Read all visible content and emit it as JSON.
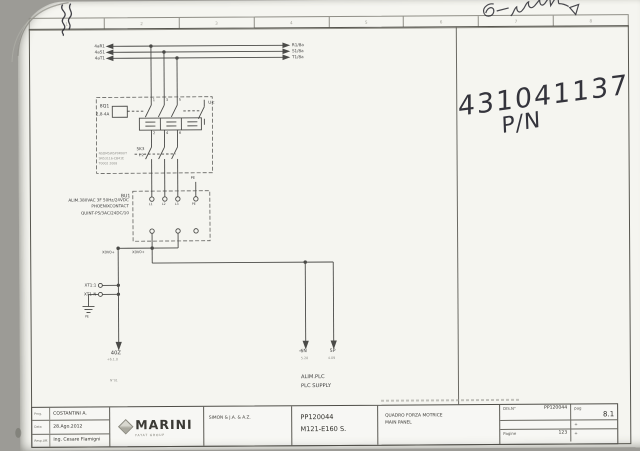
{
  "scan": {
    "part_number": "431041137",
    "part_number_label": "P/N"
  },
  "ruler": {
    "cols": [
      "1",
      "2",
      "3",
      "4",
      "5",
      "6",
      "7",
      "8"
    ]
  },
  "schematic": {
    "bus_left": [
      "4aR1",
      "4aS1",
      "4aT1"
    ],
    "bus_right": [
      "R1/8a",
      "S1/8a",
      "T1/8a"
    ],
    "breaker": {
      "tag": "8Q1",
      "range": "2,8-4A",
      "t_top": [
        "1",
        "3",
        "5"
      ],
      "t_bot": [
        "2",
        "4",
        "6"
      ],
      "uv": "U<",
      "aux_tag": "5K3",
      "aux_ref": "1.2",
      "pn1": "NSDM5W5P0R0UT",
      "pn2": "SN53116-CB41E",
      "pn3": "T0002 2008"
    },
    "psu": {
      "tag": "BU1",
      "desc1": "ALIM.380VAC 3F 50Hz/24VDC",
      "desc2": "PHOENIXCONTACT",
      "desc3": "QUINT-PS/3AC/24DC/10",
      "pe": "PE",
      "t1": "L1",
      "t2": "L2",
      "t3": "L3",
      "t4": "PE"
    },
    "net1": "X0V0+",
    "net2": "X0V0+",
    "xt1": "XT1:1",
    "xt2": "XT1-N",
    "gnd": "PE",
    "d1_tag": "40Z",
    "d1_ref": "+6.1.0",
    "d2_tag": "-6N",
    "d2_ref": "5.28",
    "d3_tag": "5P",
    "d3_ref": "4.09",
    "cap1": "ALIM.PLC",
    "cap2": "PLC SUPPLY",
    "wireno": "N°01"
  },
  "titleblock": {
    "r1l": "Prog.",
    "r1v": "COSTANTINI A.",
    "r2l": "Data",
    "r2v": "28.Ago.2012",
    "r3l": "Resp.Uff.",
    "r3v": "Ing. Cesare Flamigni",
    "brand": "MARINI",
    "brand_sub": "FAYAT GROUP",
    "company": "SIMON & J.A. & A.Z.",
    "order": "PP120044",
    "model": "M121-E160 S.",
    "title_it": "QUADRO FORZA MOTRICE",
    "title_en": "MAIN PANEL",
    "dis_l": "DIS.N°",
    "dis_v": "PP120044",
    "pag_l": "pag",
    "pag_v": "8.1",
    "rev": "+",
    "pages_l": "Pagine",
    "pages_v": "123",
    "rev2": "+"
  }
}
